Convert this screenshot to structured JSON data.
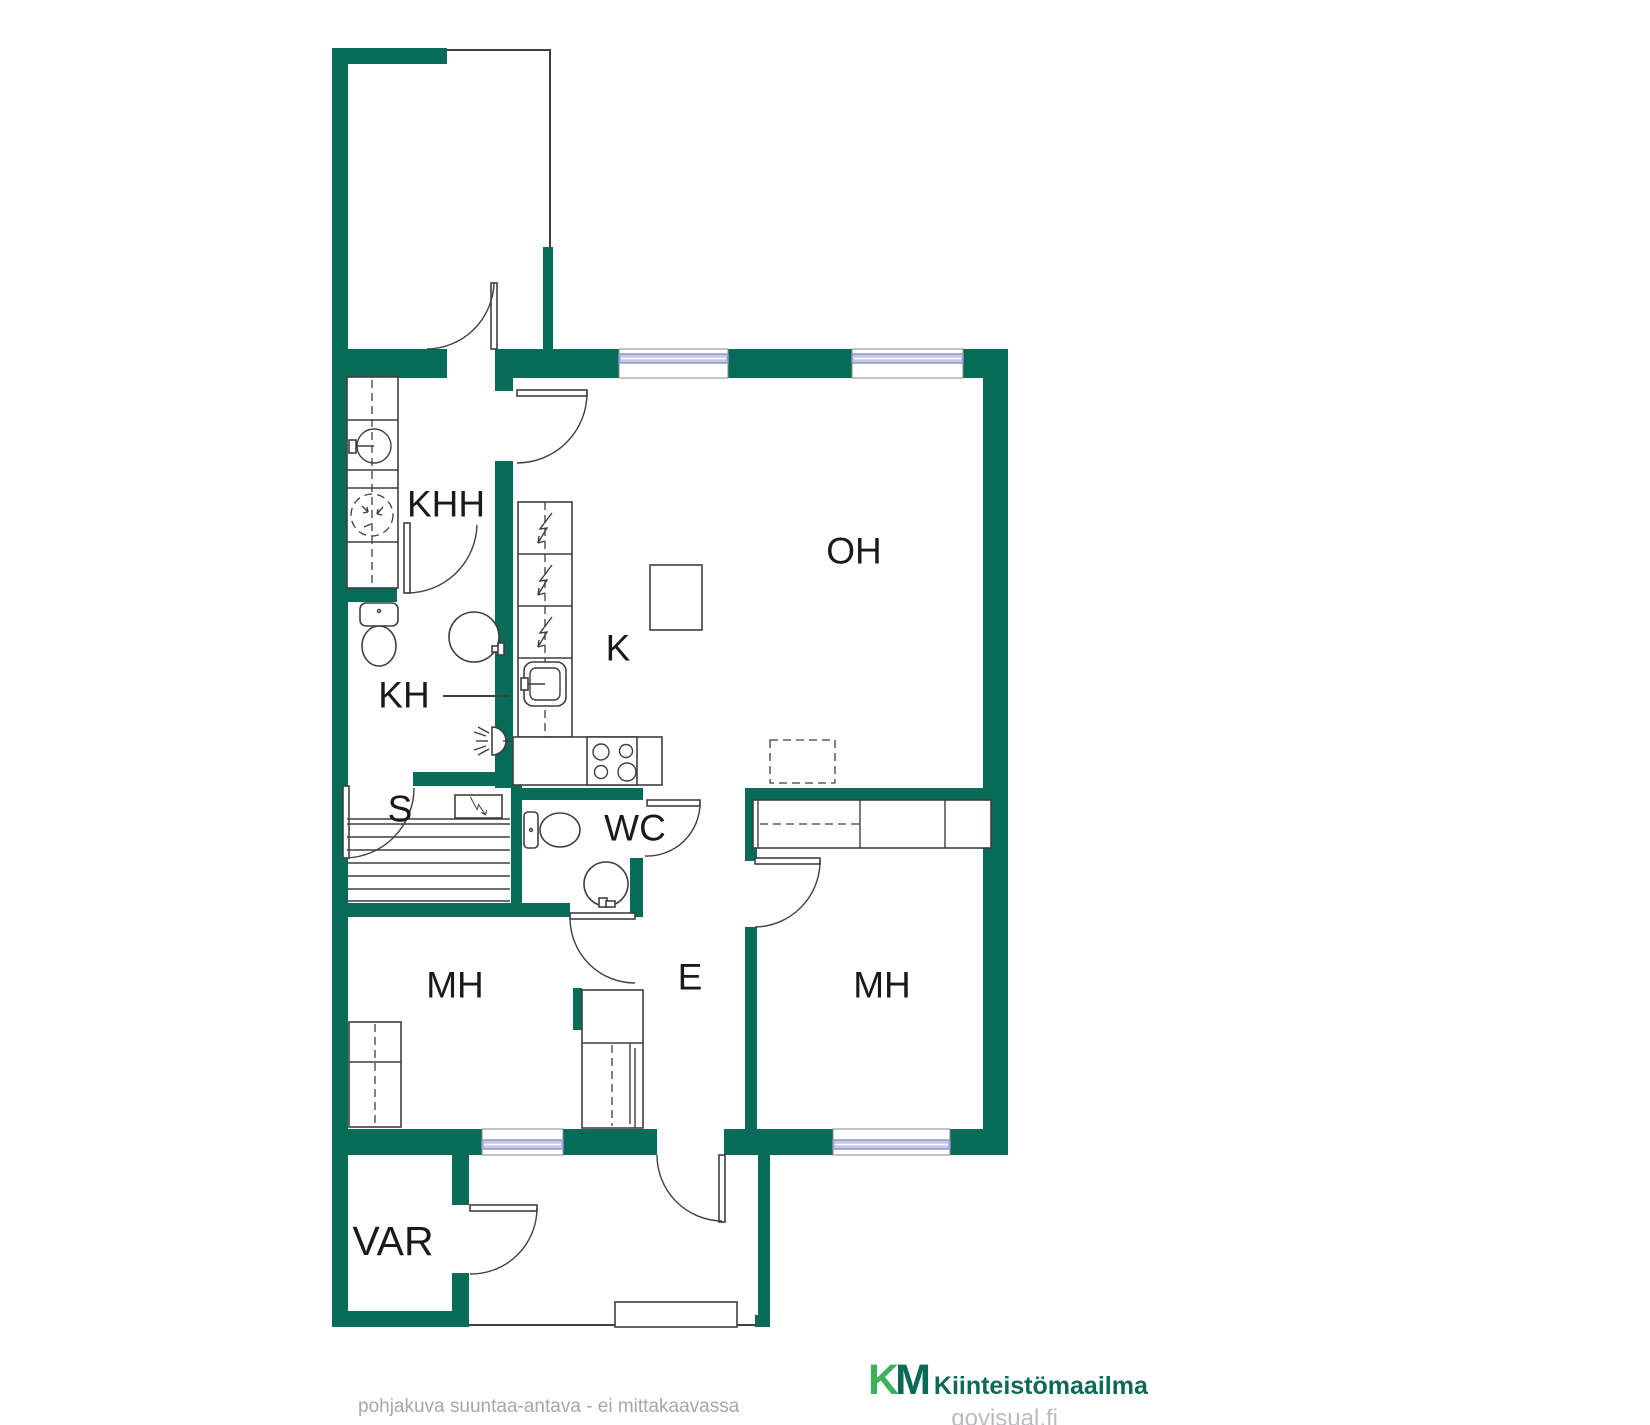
{
  "rooms": [
    {
      "id": "khh",
      "label": "KHH"
    },
    {
      "id": "kh",
      "label": "KH"
    },
    {
      "id": "s",
      "label": "S"
    },
    {
      "id": "k",
      "label": "K"
    },
    {
      "id": "oh",
      "label": "OH"
    },
    {
      "id": "wc",
      "label": "WC"
    },
    {
      "id": "mh_left",
      "label": "MH"
    },
    {
      "id": "e",
      "label": "E"
    },
    {
      "id": "mh_right",
      "label": "MH"
    },
    {
      "id": "var",
      "label": "VAR"
    }
  ],
  "footer": {
    "note": "pohjakuva suuntaa-antava - ei mittakaavassa",
    "watermark": "govisual.fi"
  },
  "branding": {
    "logo_k": "K",
    "logo_m": "M",
    "logo_name": "Kiinteistömaailma"
  },
  "colors": {
    "wall": "#076b57",
    "line": "#3f3f3f",
    "window_fill": "#c3c8e6",
    "window_border": "#8d95c8",
    "label": "#1a1a1a",
    "footer_gray": "#a8a8a8",
    "logo_k": "#3fb05c",
    "logo_m": "#0a6a56",
    "logo_text": "#0d6a58",
    "watermark_gray": "#b9bcc0"
  }
}
